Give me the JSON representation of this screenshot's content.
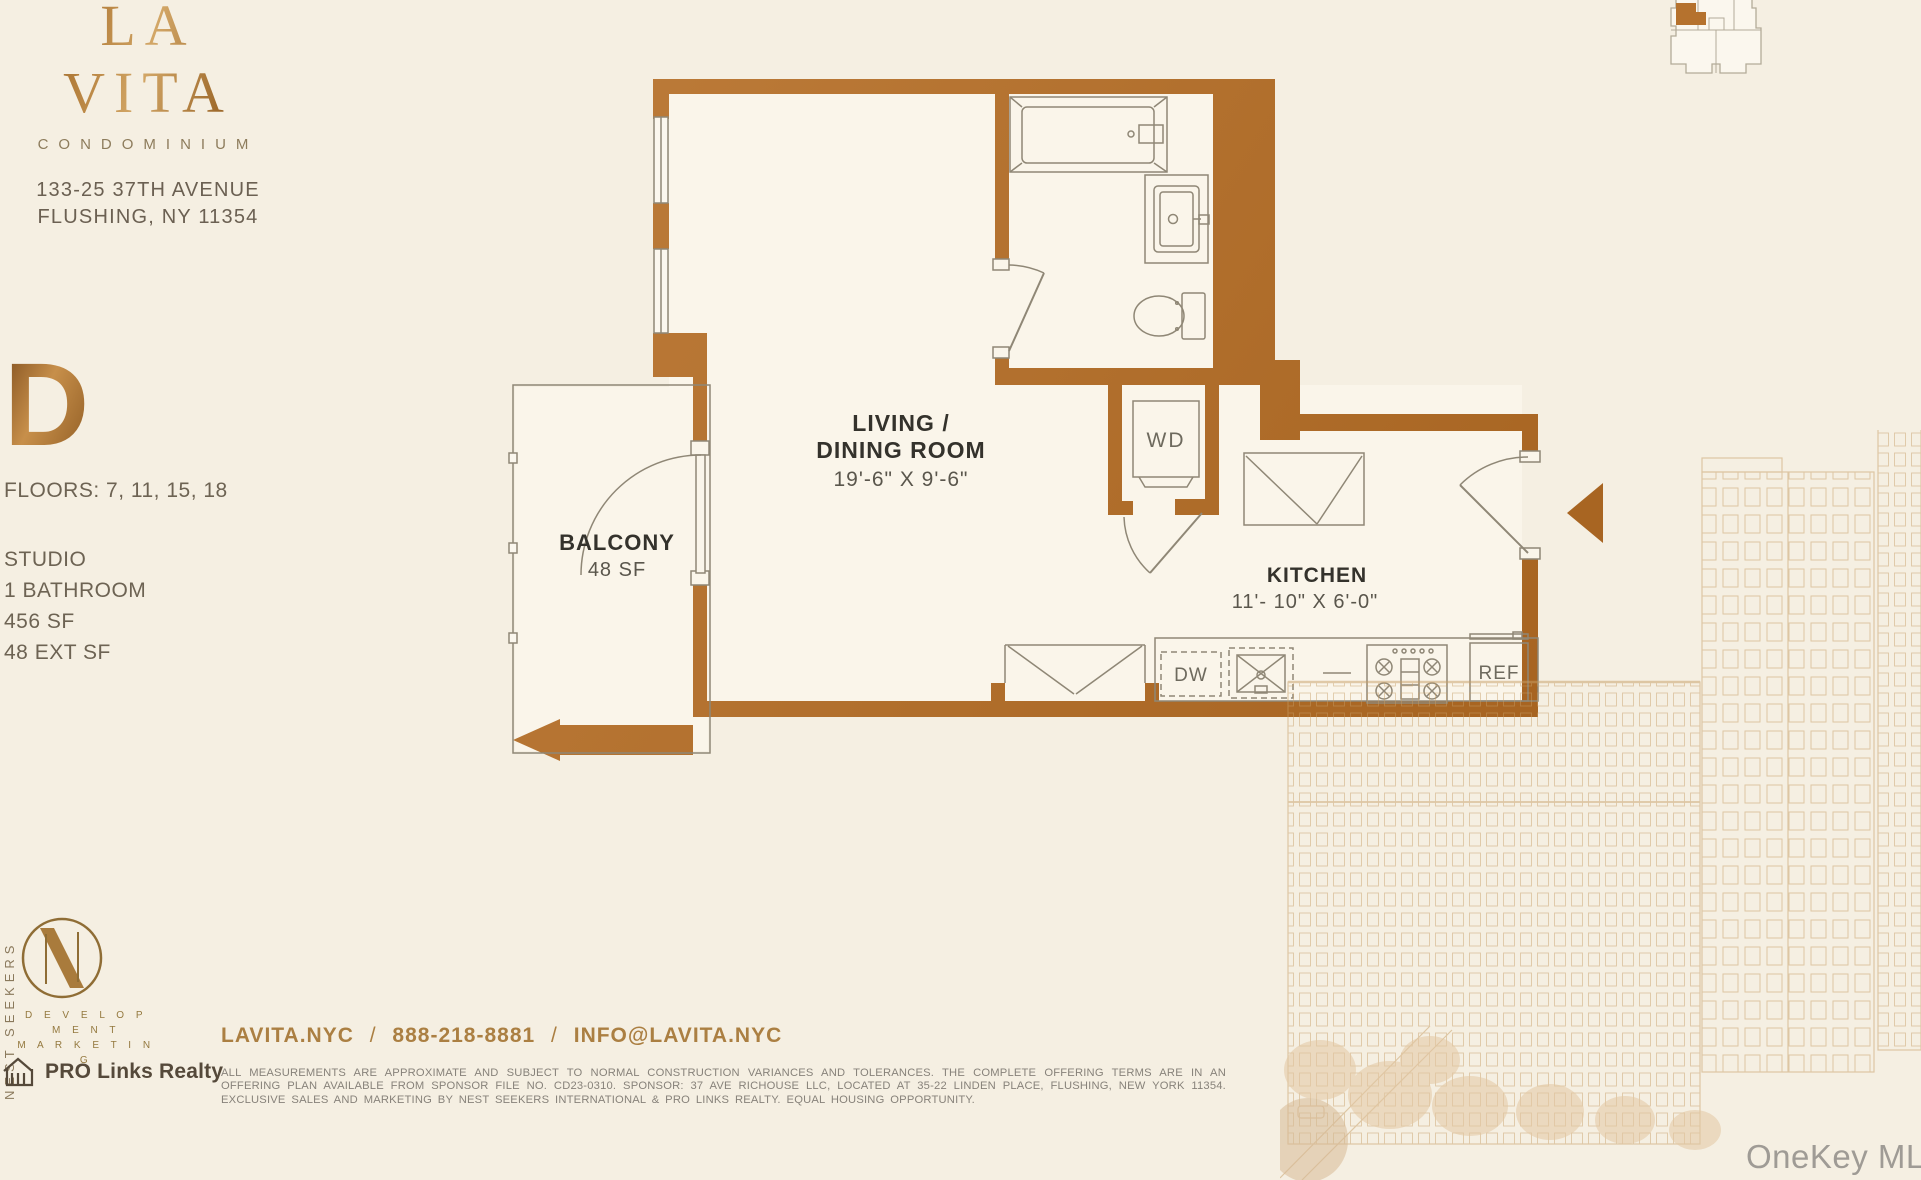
{
  "brand": {
    "name": "LA VITA",
    "type": "CONDOMINIUM",
    "address_line1": "133-25 37TH AVENUE",
    "address_line2": "FLUSHING, NY 11354"
  },
  "unit": {
    "letter": "D",
    "floors_label": "FLOORS: 7, 11, 15, 18",
    "specs": [
      "STUDIO",
      "1 BATHROOM",
      "456 SF",
      "48 EXT SF"
    ]
  },
  "floorplan": {
    "living": {
      "line1": "LIVING /",
      "line2": "DINING ROOM",
      "dims": "19'-6\" X 9'-6\""
    },
    "balcony": {
      "name": "BALCONY",
      "area": "48 SF"
    },
    "kitchen": {
      "name": "KITCHEN",
      "dims": "11'- 10\" X 6'-0\""
    },
    "appliances": {
      "washer_dryer": "WD",
      "dishwasher": "DW",
      "refrigerator": "REF"
    }
  },
  "footer": {
    "contact": {
      "website": "LAVITA.NYC",
      "phone": "888-218-8881",
      "email": "INFO@LAVITA.NYC",
      "separator": "/"
    },
    "disclaimer": "ALL MEASUREMENTS ARE APPROXIMATE AND SUBJECT TO NORMAL CONSTRUCTION VARIANCES AND TOLERANCES. THE COMPLETE OFFERING TERMS ARE IN AN OFFERING PLAN AVAILABLE FROM SPONSOR FILE NO. CD23-0310. SPONSOR: 37 AVE RICHOUSE LLC, LOCATED AT 35-22 LINDEN PLACE, FLUSHING, NEW YORK 11354. EXCLUSIVE SALES AND MARKETING BY NEST SEEKERS INTERNATIONAL & PRO LINKS REALTY. EQUAL HOUSING OPPORTUNITY."
  },
  "logos": {
    "nest_seekers": {
      "vertical_text": "NEST SEEKERS",
      "sub_line1": "D E V E L O P M E N T",
      "sub_line2": "M A R K E T I N G"
    },
    "pro_links": {
      "label": "PRO Links Realty"
    }
  },
  "watermark": {
    "label": "OneKey MLS"
  },
  "colors": {
    "wall_bronze": "#b5722e",
    "logo_bronze": "#a9782f",
    "cream": "#f5efe2",
    "plan_floor": "#faf5ea",
    "label_dark": "#34322c",
    "dim_gray": "#5a564c",
    "warm_gray": "#6d6353",
    "disclaimer_gray": "#87827a",
    "illustration": "#c79e66"
  }
}
